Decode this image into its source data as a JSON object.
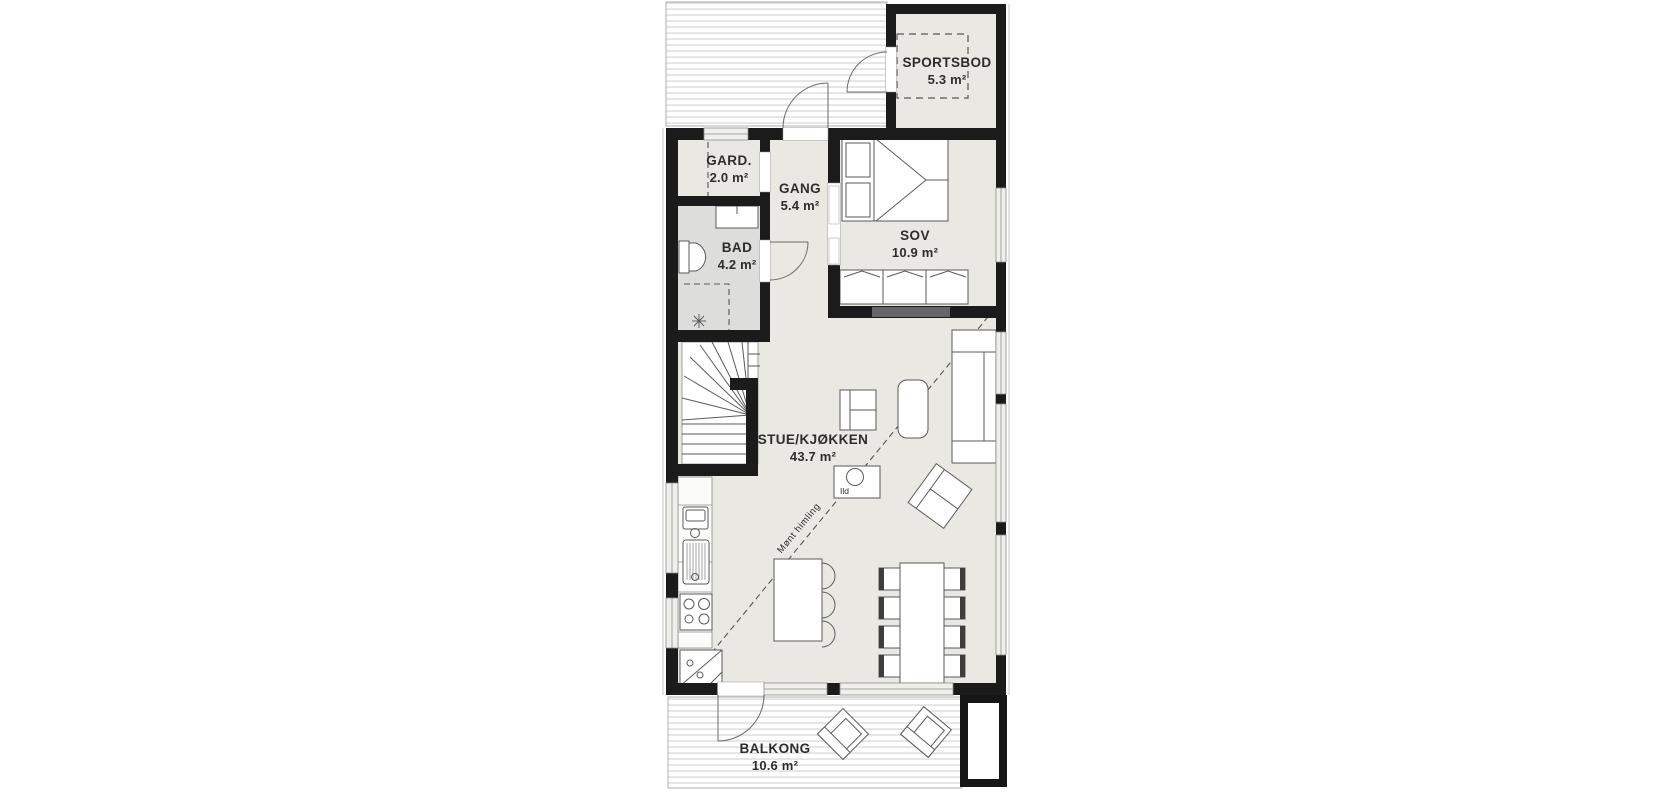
{
  "document": {
    "background": "#ffffff"
  },
  "plan": {
    "type": "floor-plan",
    "colors": {
      "wall": "#1b1b1b",
      "floor": "#e9e8e2",
      "bathroom_floor": "#dddddc",
      "deck_lines": "#d8d8d5",
      "text": "#2d2d2d"
    },
    "rooms": [
      {
        "name": "SPORTSBOD",
        "area": "5.3 m²"
      },
      {
        "name": "GARD.",
        "area": "2.0 m²"
      },
      {
        "name": "GANG",
        "area": "5.4 m²"
      },
      {
        "name": "BAD",
        "area": "4.2 m²"
      },
      {
        "name": "SOV",
        "area": "10.9 m²"
      },
      {
        "name": "STUE/KJØKKEN",
        "area": "43.7 m²"
      },
      {
        "name": "BALKONG",
        "area": "10.6 m²"
      }
    ],
    "annotations": {
      "fireplace": "Ild",
      "ceiling": "Mønt himling"
    }
  }
}
